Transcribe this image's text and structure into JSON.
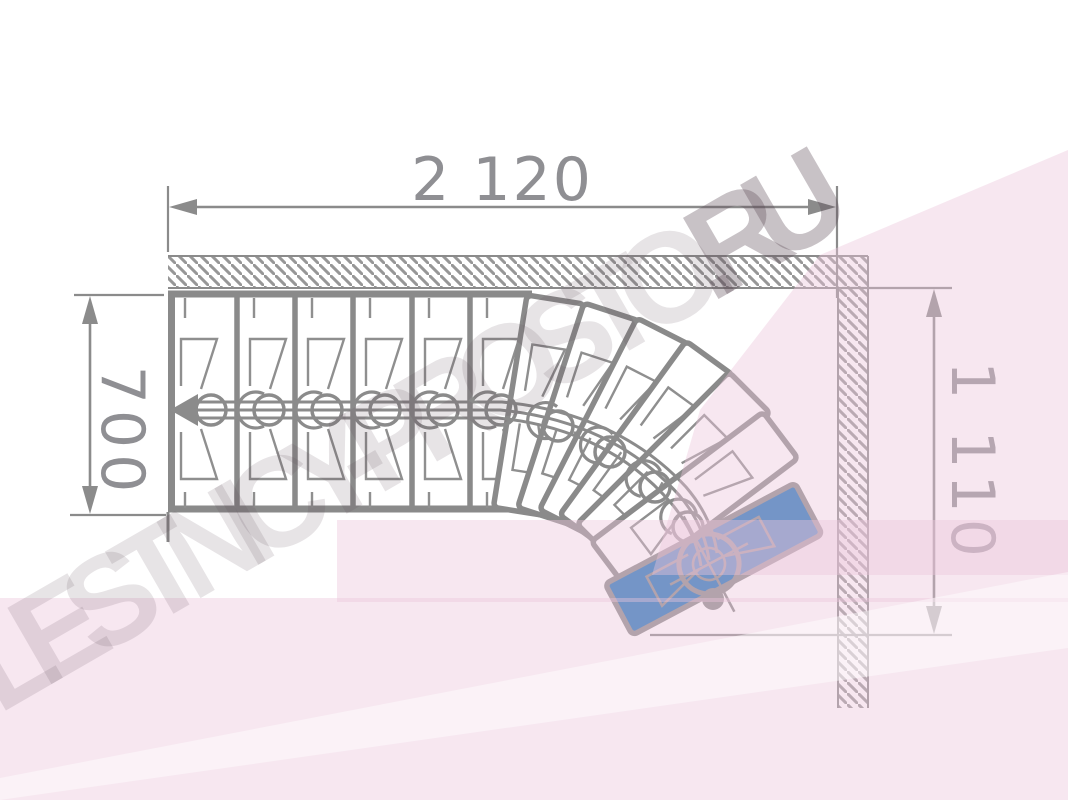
{
  "watermark": {
    "text_main": "LESTNICY-PROSTO",
    "text_suffix": ".RU"
  },
  "dimensions": {
    "top": {
      "label": "2 120",
      "orientation": "horizontal"
    },
    "left": {
      "label": "700",
      "orientation": "vertical"
    },
    "right": {
      "label": "1 110",
      "orientation": "vertical"
    }
  },
  "stair": {
    "type": "modular stair plan, 90-degree right turn",
    "straight_treads": 6,
    "winder_treads": 7,
    "highlighted_tread": "last winder tread",
    "walk_line": "center spine with module circles, entry arrow at left, center pole on highlighted tread"
  },
  "colors": {
    "line_gray": "#8b8b8b",
    "dim_text_gray": "#8f8f93",
    "highlight_blue": "#1e73b8",
    "watermark_pink": "#f8ecf3",
    "background": "#ffffff"
  }
}
